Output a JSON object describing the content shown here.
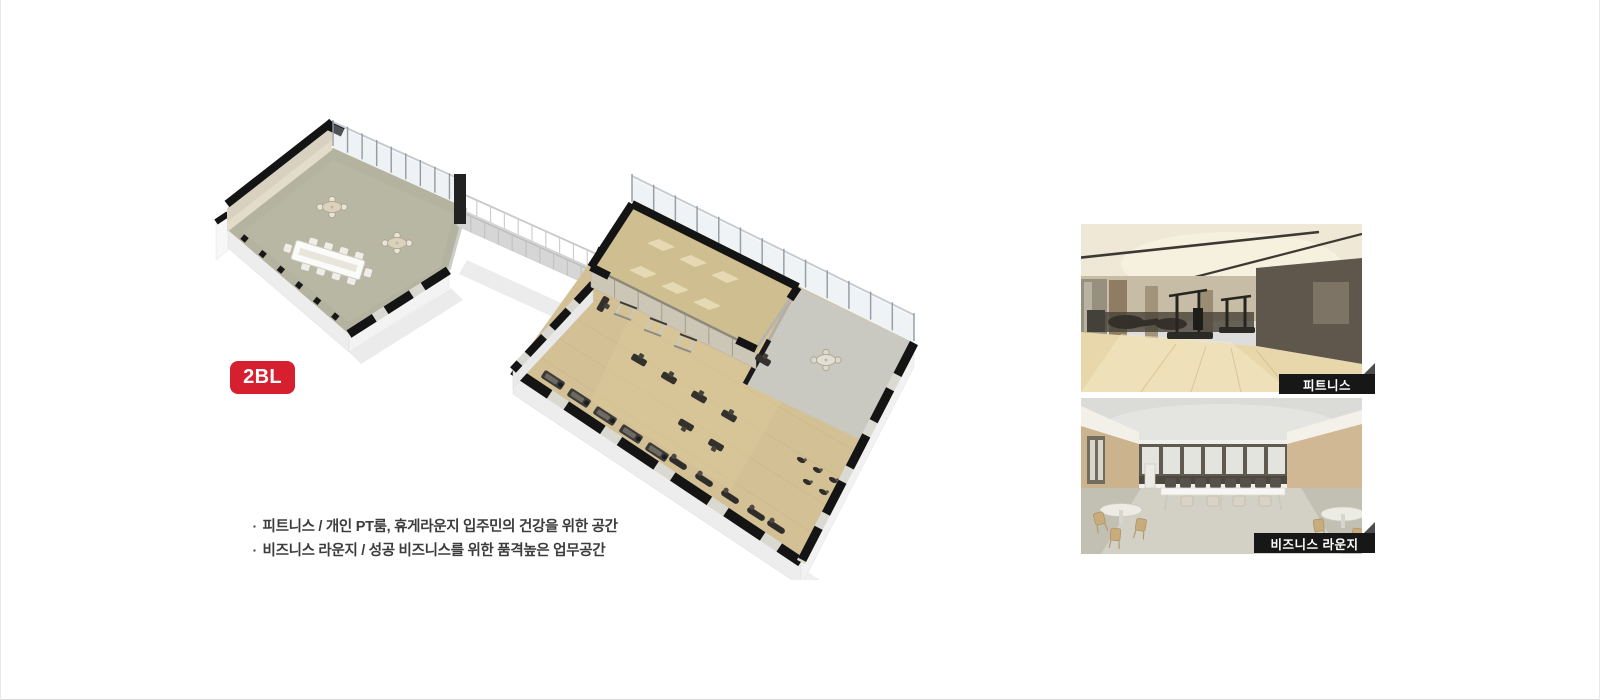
{
  "badge": {
    "label": "2BL"
  },
  "bullet_marker": "▪",
  "bullets": [
    "피트니스 / 개인 PT룸, 휴게라운지 입주민의 건강을 위한 공간",
    "비즈니스 라운지 / 성공 비즈니스를 위한 품격높은 업무공간"
  ],
  "photos": [
    {
      "id": "fitness",
      "label": "피트니스"
    },
    {
      "id": "business-lounge",
      "label": "비즈니스 라운지"
    }
  ],
  "colors": {
    "accent_red": "#d6202f",
    "photo_label_bg": "#171717",
    "photo_label_text": "#ffffff"
  }
}
